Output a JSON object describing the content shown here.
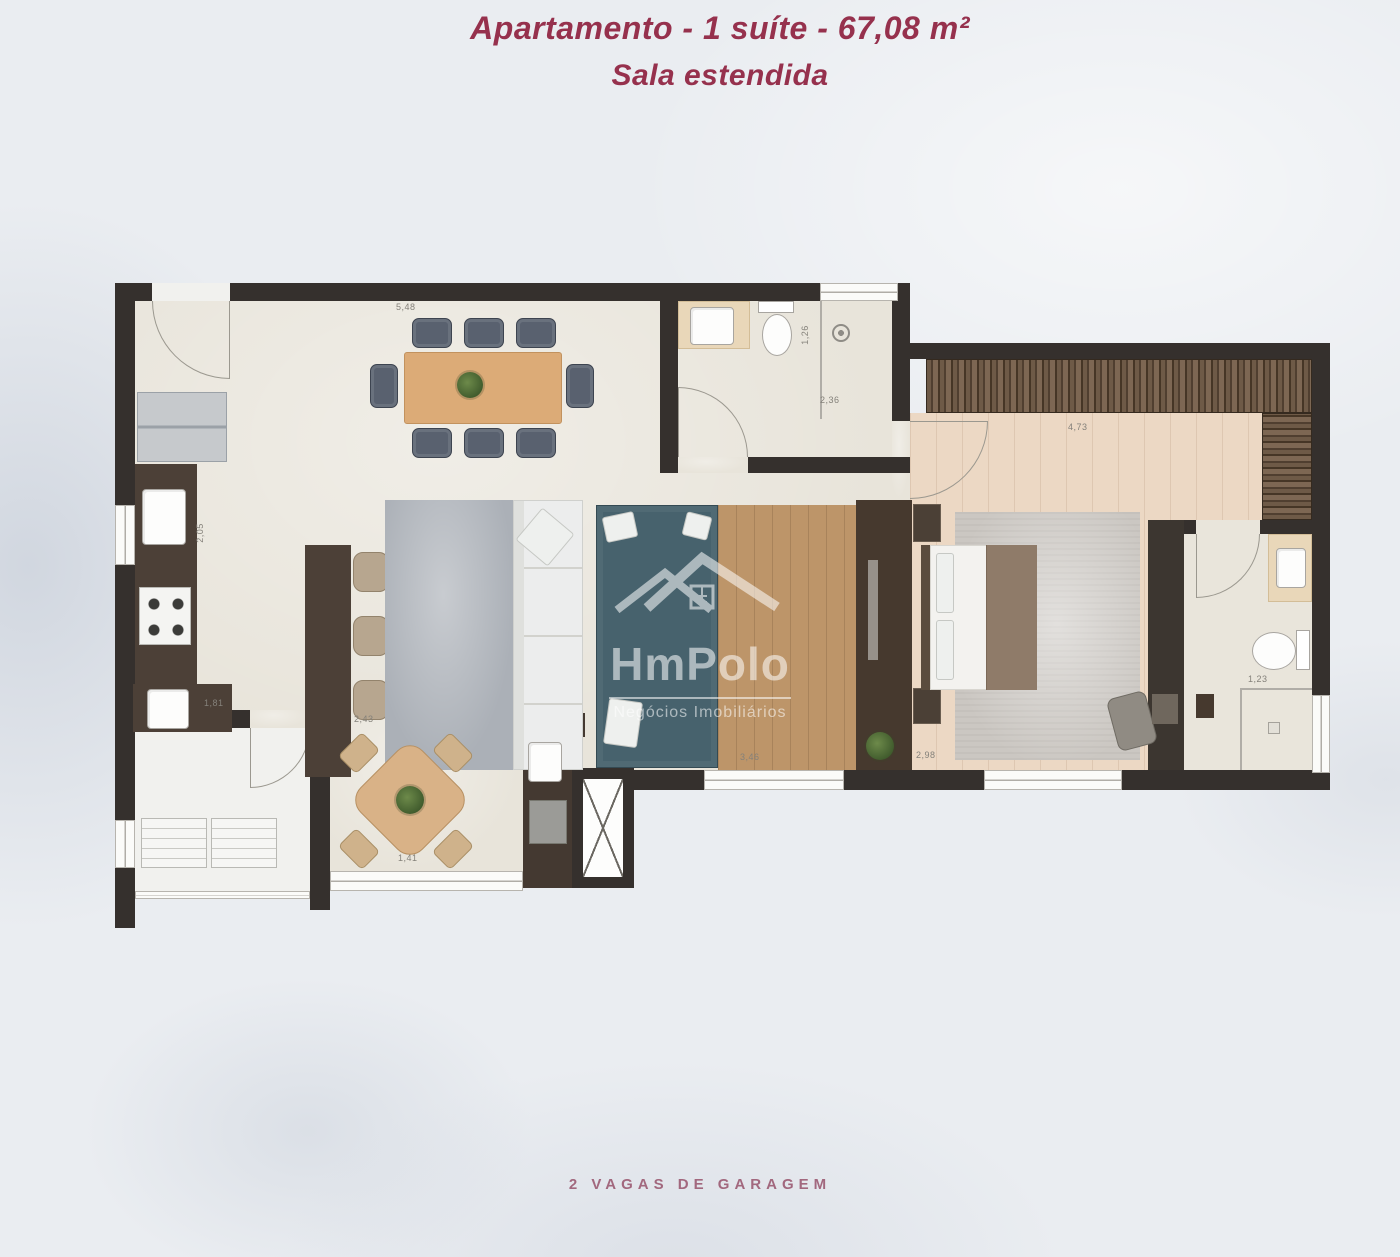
{
  "header": {
    "title": "Apartamento - 1 suíte - 67,08 m²",
    "subtitle": "Sala estendida"
  },
  "footer": {
    "note": "2 VAGAS DE GARAGEM"
  },
  "watermark": {
    "brand": "HmPolo",
    "tagline": "Negócios Imobiliários"
  },
  "dimensions": [
    {
      "label": "5,48"
    },
    {
      "label": "2,05"
    },
    {
      "label": "1,81"
    },
    {
      "label": "2,43"
    },
    {
      "label": "1,41"
    },
    {
      "label": "1,26"
    },
    {
      "label": "2,36"
    },
    {
      "label": "4,73"
    },
    {
      "label": "2,98"
    },
    {
      "label": "3,46"
    },
    {
      "label": "1,23"
    }
  ],
  "colors": {
    "title_text": "#96314d",
    "footer_text": "#a2687e",
    "background": "#eaedf1",
    "wall": "#35302d",
    "floor_main": "#e8e4da",
    "floor_wood": "#bd9569",
    "floor_suite": "#ecd8c4",
    "sofa_teal": "#47626d",
    "rug_gray": "#abb0b7",
    "wood_table": "#dcab77",
    "counter_dark": "#4c4037",
    "watermark": "#ffffff"
  }
}
